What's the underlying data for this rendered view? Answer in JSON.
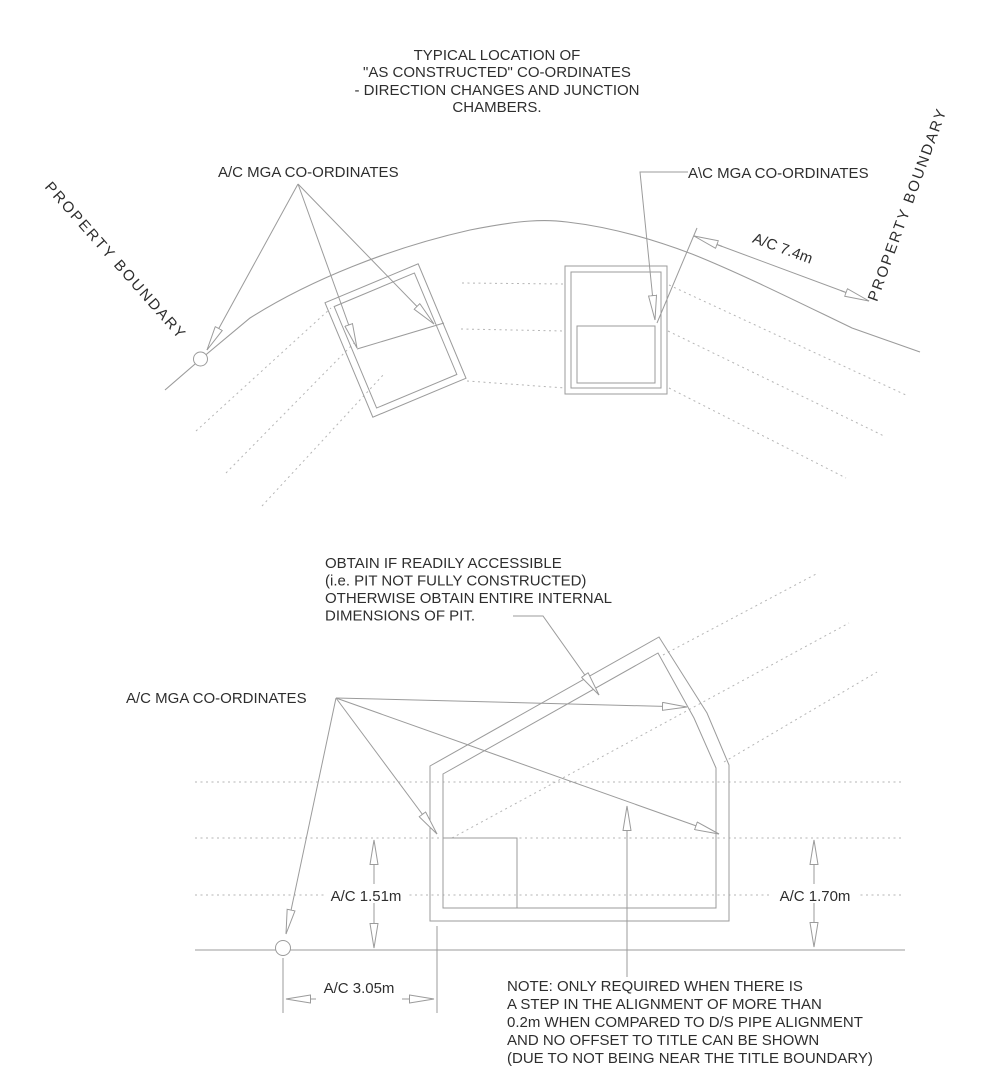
{
  "meta": {
    "description": "CAD style utility as-constructed survey detail drawing",
    "colors": {
      "background": "#ffffff",
      "line": "#9b9b9b",
      "dashed_line": "#b5b5b5",
      "text": "#2e2e2e"
    }
  },
  "title": {
    "lines": [
      "TYPICAL LOCATION OF",
      "\"AS CONSTRUCTED\" CO-ORDINATES",
      "- DIRECTION CHANGES AND JUNCTION",
      "CHAMBERS."
    ]
  },
  "top_diagram": {
    "label_left": "A/C MGA CO-ORDINATES",
    "label_right": "A\\C MGA CO-ORDINATES",
    "property_boundary_left": "PROPERTY BOUNDARY",
    "property_boundary_right": "PROPERTY BOUNDARY",
    "dimension_offset": "A/C 7.4m"
  },
  "bottom_diagram": {
    "obtain_note": {
      "lines": [
        "OBTAIN IF READILY ACCESSIBLE",
        "(i.e. PIT NOT FULLY CONSTRUCTED)",
        "OTHERWISE OBTAIN ENTIRE INTERNAL",
        "DIMENSIONS OF PIT."
      ]
    },
    "label_coords": "A/C MGA CO-ORDINATES",
    "dim_height_left": "A/C 1.51m",
    "dim_height_right": "A/C 1.70m",
    "dim_width": "A/C 3.05m",
    "note": {
      "lines": [
        "NOTE: ONLY REQUIRED WHEN THERE IS",
        "A STEP IN THE ALIGNMENT OF MORE THAN",
        "0.2m WHEN COMPARED TO D/S PIPE ALIGNMENT",
        "AND NO OFFSET TO TITLE CAN BE SHOWN",
        "(DUE TO NOT BEING NEAR THE TITLE BOUNDARY)"
      ]
    }
  }
}
